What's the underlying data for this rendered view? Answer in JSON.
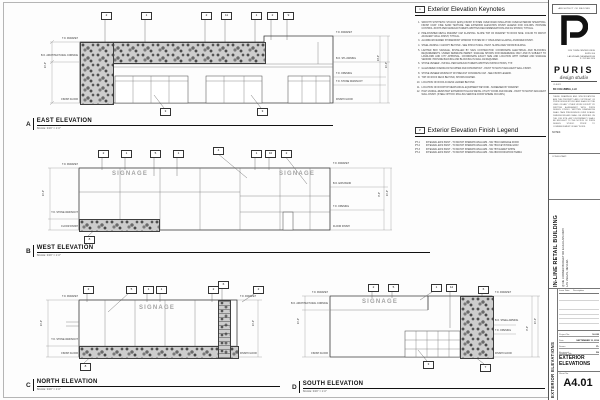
{
  "keynotes": {
    "icon": "1",
    "title": "Exterior Elevation Keynotes",
    "items": [
      {
        "n": "1.",
        "text": "SMOOTH SYNTHETIC STUCCO (EIFS) FINISH SYSTEM OVER RIGID INSULATION OVER EXTERIOR SHEATHING. FINISH COAT: FINE SAND TEXTURE. SEE EXTERIOR ELEVATION FINISH LEGEND FOR COLORS. PROVIDE CONTROL JOINTS PER MANUFACTURER'S WRITTEN RECOMMENDATIONS AND AS SHOWN, TYPICAL."
      },
      {
        "n": "2.",
        "text": "PRE-FINISHED METAL PARAPET CAP FLASHING. SLOPE TOP OF PARAPET TO ROOF SIDE. COLOR TO MATCH ADJACENT WALL FINISH, TYPICAL."
      },
      {
        "n": "3.",
        "text": "ALUMINUM FRAMED STOREFRONT WINDOW SYSTEM W/ 1\" INSULATED GLAZING, ANODIZED FINISH."
      },
      {
        "n": "4.",
        "text": "STEEL AWNING / CANOPY BEYOND - SEE STRUCTURAL. PAINT. SLOPE AWAY FROM BUILDING."
      },
      {
        "n": "5.",
        "text": "LIGHTED BOX SIGNAGE, INSTALLED BY SIGN CONTRACTOR. COORDINATE ELECTRICAL AND BLOCKING REQUIREMENTS. UNDER SEPARATE PERMIT. SIGNAGE SHOWN FOR REFERENCE ONLY AND IS SUBJECT TO LANDLORD AND CITY APPROVAL. COORDINATE EXACT SIZE AND LOCATION WITH OWNER AND SIGNAGE VENDOR. PROVIDE BACKING AND BLOCKING IN WALL AS REQUIRED."
      },
      {
        "n": "6.",
        "text": "STONE VENEER - INSTALL PER MANUFACTURER'S WRITTEN INSTRUCTIONS, TYP."
      },
      {
        "n": "7.",
        "text": "GALVANIZED OVERFLOW SCUPPER AND DOWNSPOUT - PAINT TO MATCH ADJACENT WALL FINISH."
      },
      {
        "n": "8.",
        "text": "STONE VENEER WAINSCOT W/ PRECAST CONCRETE CAP - SEE FINISH LEGEND."
      },
      {
        "n": "9.",
        "text": "TOP OF ROOF DECK BEYOND, SHOWN DASHED."
      },
      {
        "n": "10.",
        "text": "LOCATION OF ROOF ACCESS LADDER BEYOND."
      },
      {
        "n": "11.",
        "text": "LOCATION OF ROOFTOP MECHANICAL EQUIPMENT BEYOND - SCREENED BY PARAPET."
      },
      {
        "n": "12.",
        "text": "HIGH VANDAL-RESISTANT EXTERIOR HOLLOW METAL UTILITY DOOR AND FRAME - PAINT TO MATCH ADJACENT WALL FINISH. (STEEL OPTION: ROLLING SERVICE DOOR WHERE OCCURS.)"
      }
    ]
  },
  "finish_legend": {
    "icon": "P",
    "title": "Exterior Elevation Finish Legend",
    "items": [
      {
        "code": "PT-1",
        "text": "INTEGRAL EIFS PAINT - TO MATCH SHERWIN WILLIAMS - SW 7594 CARRIAGE DOOR"
      },
      {
        "code": "PT-2",
        "text": "INTEGRAL EIFS PAINT - TO MATCH SHERWIN WILLIAMS - SW 7504 KEYSTONE GRAY"
      },
      {
        "code": "PT-3",
        "text": "INTEGRAL EIFS PAINT - TO MATCH SHERWIN WILLIAMS - SW 7570 EGRET WHITE"
      },
      {
        "code": "PT-4",
        "text": "INTEGRAL EIFS PAINT - TO MATCH SHERWIN WILLIAMS - SW 2803 ROOKWOOD TERRA"
      }
    ]
  },
  "elevation_titles": [
    {
      "x": 26,
      "y": 118,
      "w": 307,
      "letter": "A",
      "title": "EAST ELEVATION",
      "scale": "SCALE: 3/16\" = 1'-0\""
    },
    {
      "x": 26,
      "y": 245,
      "w": 404,
      "letter": "B",
      "title": "WEST ELEVATION",
      "scale": "SCALE: 3/16\" = 1'-0\""
    },
    {
      "x": 26,
      "y": 379,
      "w": 254,
      "letter": "C",
      "title": "NORTH ELEVATION",
      "scale": "SCALE: 3/16\" = 1'-0\""
    },
    {
      "x": 292,
      "y": 381,
      "w": 253,
      "letter": "D",
      "title": "SOUTH ELEVATION",
      "scale": "SCALE: 3/16\" = 1'-0\""
    }
  ],
  "signage": [
    {
      "x": 95,
      "y": 171,
      "t": "SIGNAGE"
    },
    {
      "x": 262,
      "y": 171,
      "t": "SIGNAGE"
    },
    {
      "x": 122,
      "y": 305,
      "t": "SIGNAGE"
    },
    {
      "x": 345,
      "y": 299,
      "t": "SIGNAGE"
    }
  ],
  "tags": [
    {
      "x": 101,
      "y": 12,
      "n": "2"
    },
    {
      "x": 141,
      "y": 12,
      "n": "1"
    },
    {
      "x": 201,
      "y": 12,
      "n": "2"
    },
    {
      "x": 221,
      "y": 12,
      "n": "11"
    },
    {
      "x": 251,
      "y": 12,
      "n": "1"
    },
    {
      "x": 267,
      "y": 12,
      "n": "2"
    },
    {
      "x": 283,
      "y": 12,
      "n": "9"
    },
    {
      "x": 160,
      "y": 108,
      "n": "3"
    },
    {
      "x": 257,
      "y": 108,
      "n": "3"
    },
    {
      "x": 98,
      "y": 150,
      "n": "2"
    },
    {
      "x": 121,
      "y": 150,
      "n": "1"
    },
    {
      "x": 150,
      "y": 150,
      "n": "5"
    },
    {
      "x": 173,
      "y": 150,
      "n": "1"
    },
    {
      "x": 213,
      "y": 147,
      "n": "4"
    },
    {
      "x": 251,
      "y": 150,
      "n": "1"
    },
    {
      "x": 265,
      "y": 150,
      "n": "10"
    },
    {
      "x": 281,
      "y": 150,
      "n": "2"
    },
    {
      "x": 84,
      "y": 236,
      "n": "8"
    },
    {
      "x": 83,
      "y": 286,
      "n": "2"
    },
    {
      "x": 126,
      "y": 286,
      "n": "5"
    },
    {
      "x": 143,
      "y": 286,
      "n": "1"
    },
    {
      "x": 156,
      "y": 286,
      "n": "1"
    },
    {
      "x": 208,
      "y": 286,
      "n": "2"
    },
    {
      "x": 218,
      "y": 281,
      "n": "6"
    },
    {
      "x": 253,
      "y": 286,
      "n": "2"
    },
    {
      "x": 80,
      "y": 363,
      "n": "8"
    },
    {
      "x": 368,
      "y": 284,
      "n": "2"
    },
    {
      "x": 388,
      "y": 284,
      "n": "5"
    },
    {
      "x": 431,
      "y": 284,
      "n": "1"
    },
    {
      "x": 446,
      "y": 284,
      "n": "12"
    },
    {
      "x": 478,
      "y": 286,
      "n": "6"
    },
    {
      "x": 423,
      "y": 361,
      "n": "3"
    },
    {
      "x": 480,
      "y": 364,
      "n": "7"
    }
  ],
  "dim_labels_left": [
    {
      "x": 40,
      "y": 38,
      "t": "T.O. PARAPET"
    },
    {
      "x": 40,
      "y": 55,
      "t": "B.O. ARCHITECTURAL CORNICE"
    },
    {
      "x": 40,
      "y": 99,
      "t": "FINISH FLOOR"
    },
    {
      "x": 40,
      "y": 164,
      "t": "T.O. PARAPET"
    },
    {
      "x": 40,
      "y": 212,
      "t": "T.O. STONE WAINSCOT"
    },
    {
      "x": 40,
      "y": 226,
      "t": "FLOOR FINISH"
    },
    {
      "x": 40,
      "y": 296,
      "t": "T.O. PARAPET"
    },
    {
      "x": 40,
      "y": 339,
      "t": "T.O. STONE WAINSCOT"
    },
    {
      "x": 40,
      "y": 353,
      "t": "FINISH FLOOR"
    },
    {
      "x": 290,
      "y": 292,
      "t": "T.O. PARAPET"
    },
    {
      "x": 290,
      "y": 303,
      "t": "B.O. ARCHITECTURAL CORNICE"
    },
    {
      "x": 290,
      "y": 353,
      "t": "FINISH FLOOR"
    }
  ],
  "dim_labels_right": [
    {
      "x": 336,
      "y": 32,
      "t": "T.O. PARAPET"
    },
    {
      "x": 336,
      "y": 58,
      "t": "B.O. STL AWNING"
    },
    {
      "x": 336,
      "y": 73,
      "t": "T.O. OPENING"
    },
    {
      "x": 336,
      "y": 81,
      "t": "T.O. STONE WAINSCOT"
    },
    {
      "x": 336,
      "y": 99,
      "t": "FINISH FLOOR"
    },
    {
      "x": 333,
      "y": 163,
      "t": "T.O. PARAPET"
    },
    {
      "x": 333,
      "y": 183,
      "t": "B.O. EIFS BAND"
    },
    {
      "x": 333,
      "y": 206,
      "t": "T.O. OPENING"
    },
    {
      "x": 333,
      "y": 226,
      "t": "FLOOR FINISH"
    },
    {
      "x": 240,
      "y": 296,
      "t": "T.O. PARAPET"
    },
    {
      "x": 240,
      "y": 353,
      "t": "FINISH FLOOR"
    },
    {
      "x": 495,
      "y": 292,
      "t": "T.O. PARAPET"
    },
    {
      "x": 495,
      "y": 320,
      "t": "B.O. STEEL AWNING"
    },
    {
      "x": 495,
      "y": 330,
      "t": "T.O. OPENING"
    },
    {
      "x": 495,
      "y": 353,
      "t": "FINISH FLOOR"
    }
  ],
  "dim_values": [
    {
      "x": 44,
      "y": 62,
      "t": "24'-0\""
    },
    {
      "x": 377,
      "y": 55,
      "t": "20'-0\""
    },
    {
      "x": 385,
      "y": 62,
      "t": "24'-0\""
    },
    {
      "x": 42,
      "y": 190,
      "t": "24'-0\""
    },
    {
      "x": 378,
      "y": 192,
      "t": "9'-0\""
    },
    {
      "x": 386,
      "y": 190,
      "t": "24'-0\""
    },
    {
      "x": 40,
      "y": 320,
      "t": "24'-0\""
    },
    {
      "x": 252,
      "y": 320,
      "t": "24'-0\""
    },
    {
      "x": 297,
      "y": 318,
      "t": "24'-0\""
    },
    {
      "x": 526,
      "y": 326,
      "t": "9'-0\""
    },
    {
      "x": 534,
      "y": 318,
      "t": "24'-0\""
    }
  ],
  "titleblock": {
    "architect_header": "ARCHITECT OF RECORD",
    "logo_word": "PURIS",
    "logo_sub": "design studio",
    "address": [
      {
        "t": "1120 TOWN CENTER DRIVE"
      },
      {
        "t": "SUITE 200"
      },
      {
        "t": "LAS VEGAS, NEVADA 89144"
      },
      {
        "t": "P: 702.360.1120"
      }
    ],
    "client_label": "CLIENT:",
    "client_name": "BC COLUMBIA, LLC",
    "copyright": "THESE DRAWINGS AND SPECIFICATIONS ARE THE PROPERTY AND COPYRIGHT OF PURIS DESIGN STUDIO AND SHALL NOT BE USED ON ANY OTHER WORK EXCEPT BY WRITTEN AGREEMENT WITH PURIS DESIGN STUDIO. WRITTEN DIMENSIONS SHALL TAKE PRECEDENCE OVER SCALED DIMENSIONS AND SHALL BE VERIFIED ON THE JOB SITE. ANY DISCREPANCY SHALL BE BROUGHT TO THE NOTICE OF PURIS DESIGN STUDIO PRIOR TO COMMENCEMENT OF ANY WORK.",
    "notes_label": "NOTES:",
    "consultant_label": "CONSULTANT:",
    "project": {
      "title": "IN-LINE RETAIL BUILDING",
      "line1": "@ NE CORNER BUDGET RD & HUALAPAI WAY",
      "line2": "LAS VEGAS, NEVADA"
    },
    "rev_issue": "Issue Date",
    "rev_desc": "Description",
    "fields": [
      {
        "label": "Project No.",
        "value": "16-030"
      },
      {
        "label": "Date",
        "value": "SEPTEMBER 13, 2016"
      },
      {
        "label": "Drawn",
        "value": "PL"
      },
      {
        "label": "Reviewed",
        "value": "DS"
      }
    ],
    "drawing_title_label": "Drawing Title",
    "drawing_title": "EXTERIOR ELEVATIONS",
    "sheet_label": "Sheet No.",
    "sheet_number": "A4.01",
    "side_text": "EXTERIOR ELEVATIONS"
  }
}
